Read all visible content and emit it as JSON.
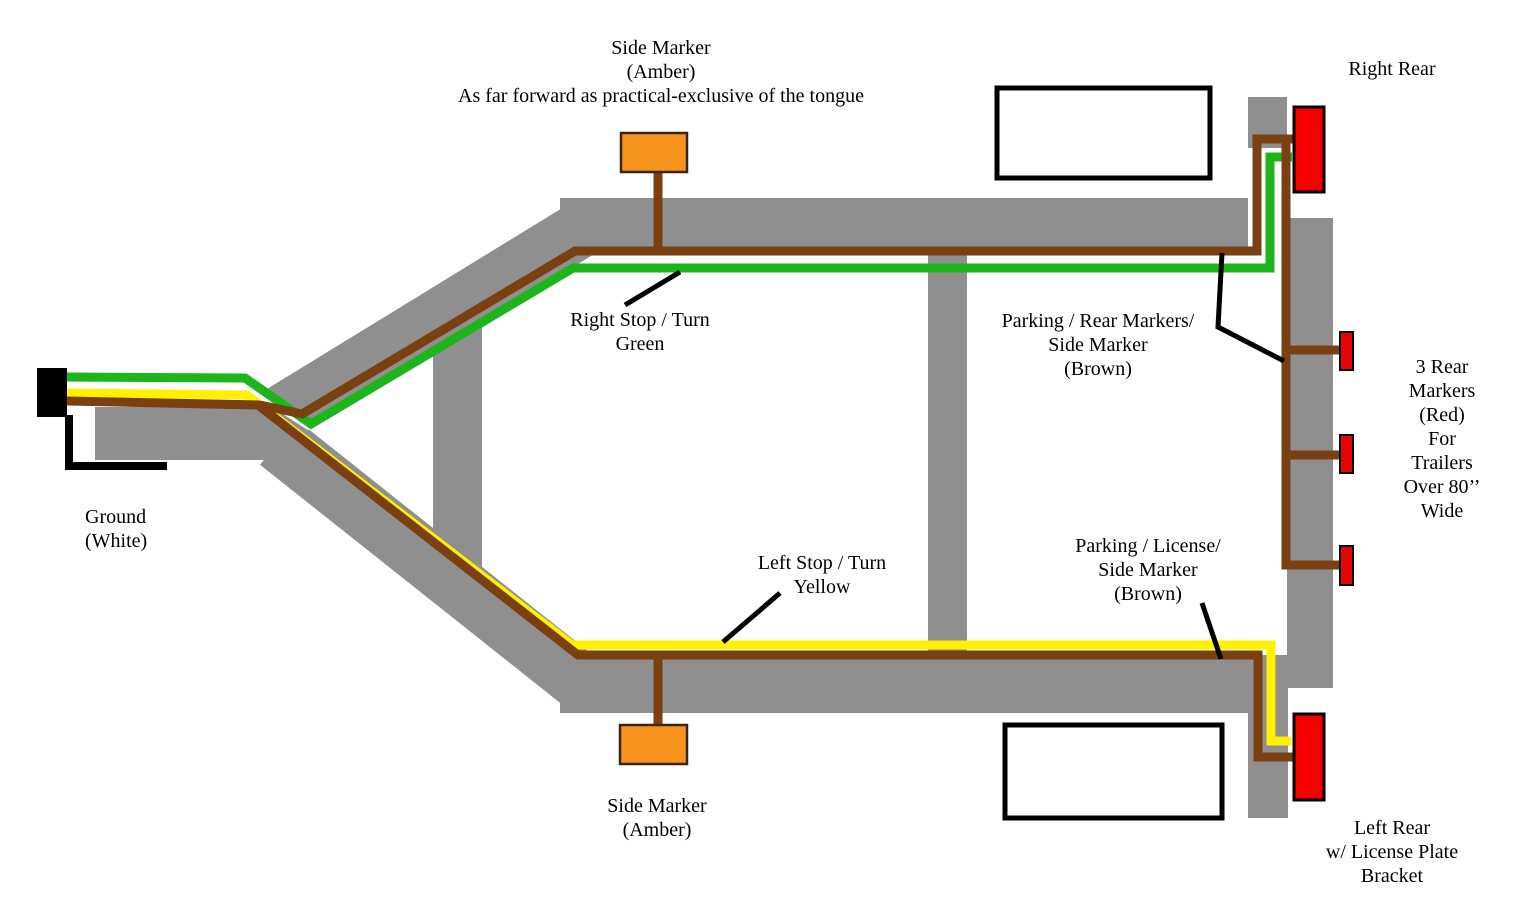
{
  "diagram": {
    "labels": {
      "side_marker_top": "Side Marker\n(Amber)\nAs far forward as practical-exclusive of the tongue",
      "right_rear": "Right Rear",
      "right_stop_turn": "Right Stop / Turn\nGreen",
      "parking_rear_markers": "Parking / Rear Markers/\nSide Marker\n(Brown)",
      "three_rear_markers": "3 Rear\nMarkers (Red)\nFor Trailers\nOver 80’’\nWide",
      "ground": "Ground\n(White)",
      "left_stop_turn": "Left Stop / Turn\nYellow",
      "parking_license": "Parking / License/\nSide Marker\n(Brown)",
      "side_marker_bottom": "Side Marker\n(Amber)",
      "left_rear": "Left Rear\nw/ License Plate\nBracket"
    },
    "colors": {
      "frame_gray": "#8F8F8F",
      "wire_green": "#1CB51C",
      "wire_yellow": "#FFF100",
      "wire_brown": "#7B4012",
      "wire_white": "#FFFFFF",
      "ground_black": "#000000",
      "marker_amber": "#F7941E",
      "light_red": "#F40000",
      "marker_red": "#E60505"
    },
    "components": {
      "connector": "4-way flat connector",
      "right_rear_light": "right rear light (red)",
      "left_rear_light": "left rear light (red)",
      "rear_markers": "3 rear marker lights (red)",
      "side_markers": "side marker lights (amber)"
    }
  }
}
